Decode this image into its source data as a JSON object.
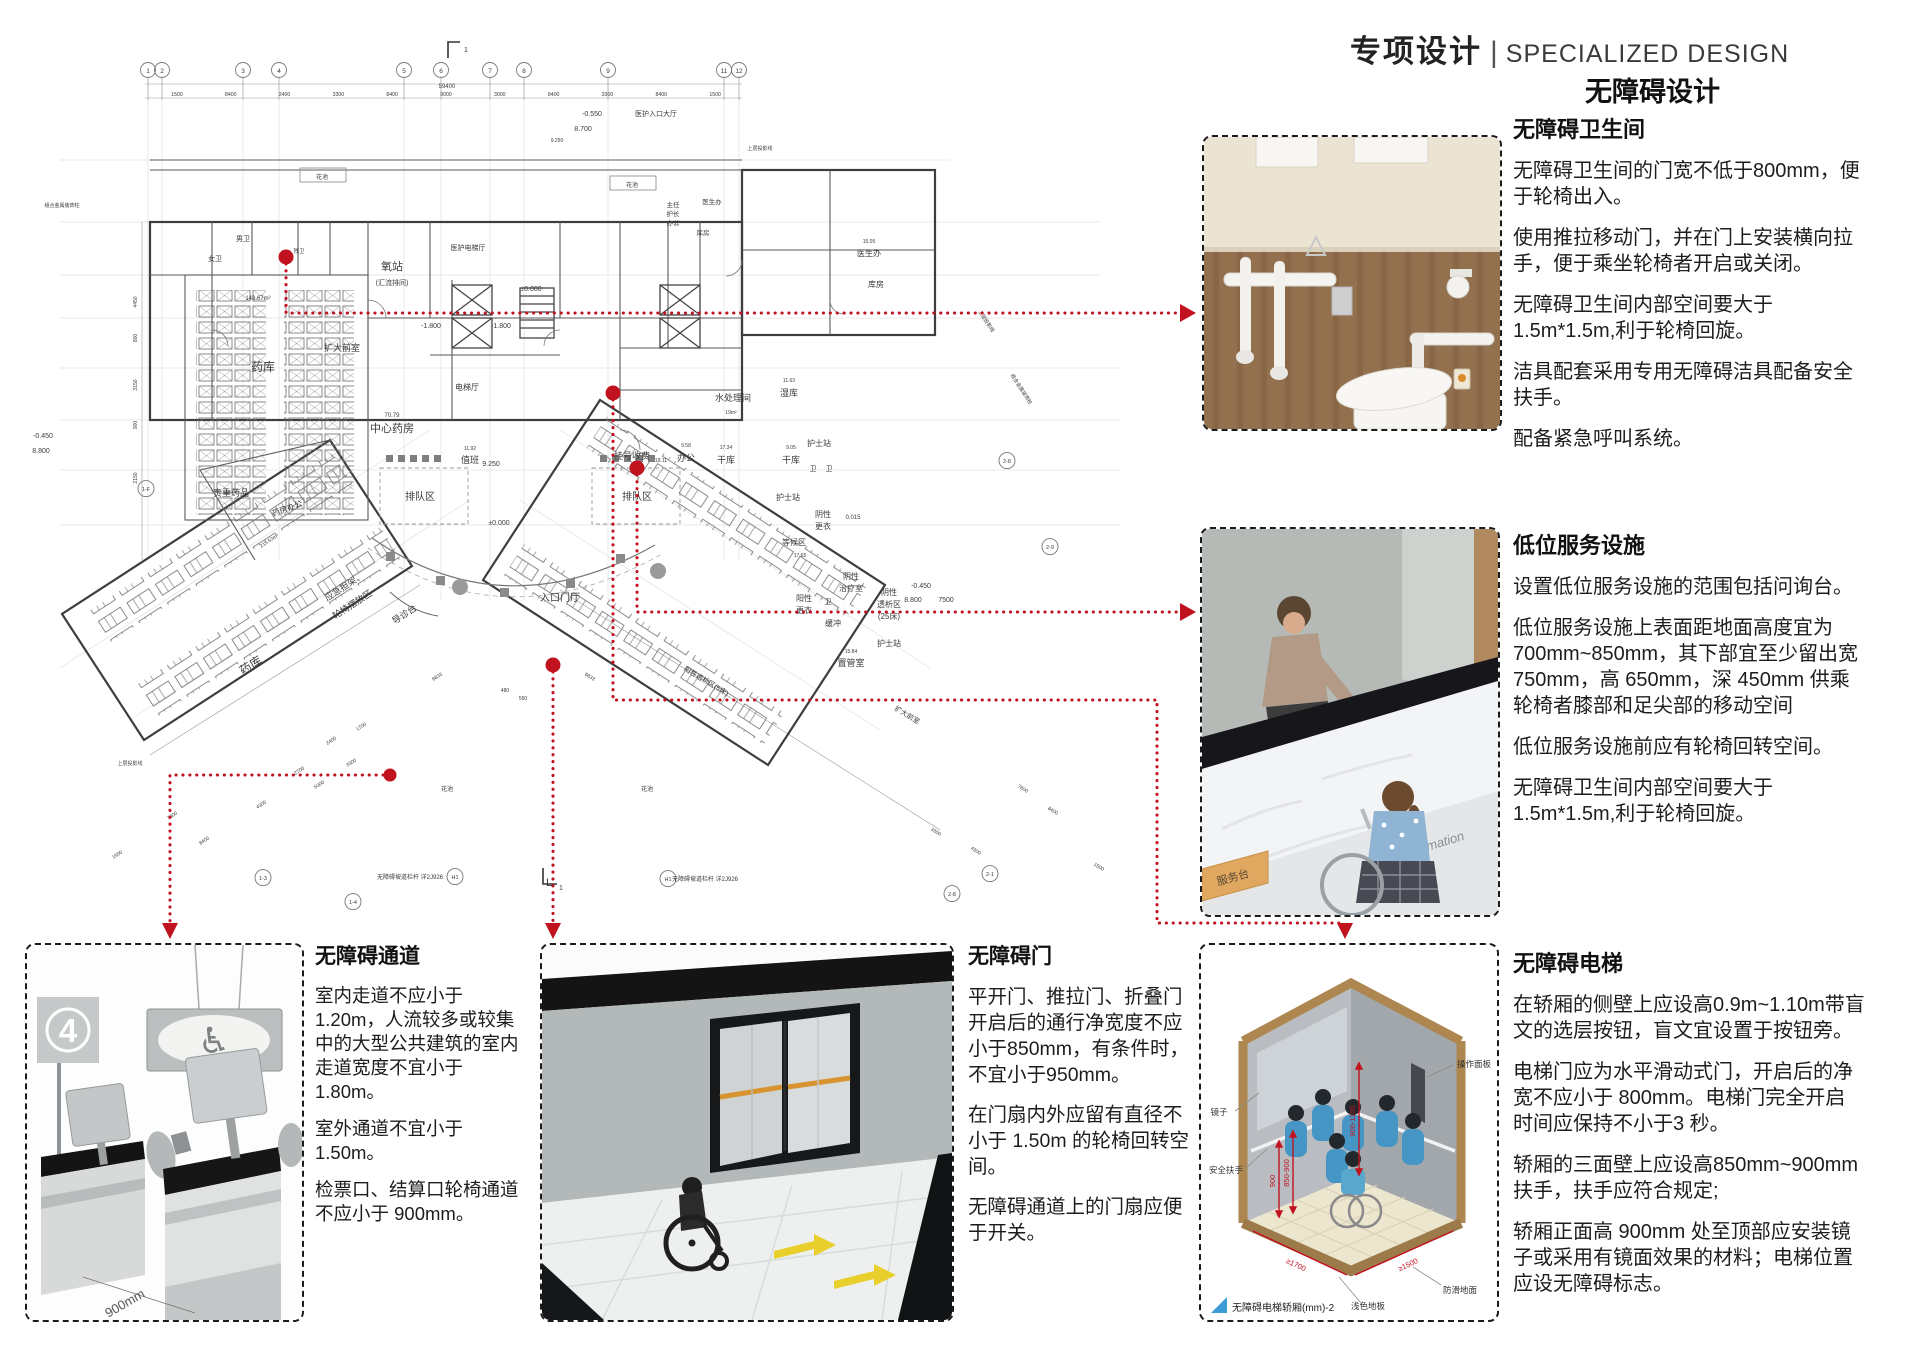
{
  "header": {
    "title_cn": "专项设计",
    "divider": "|",
    "title_en": "SPECIALIZED DESIGN",
    "subtitle": "无障碍设计"
  },
  "colors": {
    "annotation_red": "#c1121f",
    "caption_blue": "#3a9bd5",
    "accent_orange": "#d7932f",
    "wood": "#93704e"
  },
  "sections": {
    "toilet": {
      "title": "无障碍卫生间",
      "paragraphs": [
        "无障碍卫生间的门宽不低于800mm，便于轮椅出入。",
        "使用推拉移动门，并在门上安装横向拉手，便于乘坐轮椅者开启或关闭。",
        "无障碍卫生间内部空间要大于1.5m*1.5m,利于轮椅回旋。",
        "洁具配套采用专用无障碍洁具配备安全扶手。",
        "配备紧急呼叫系统。"
      ]
    },
    "service": {
      "title": "低位服务设施",
      "paragraphs": [
        "设置低位服务设施的范围包括问询台。",
        "低位服务设施上表面距地面高度宜为700mm~850mm，其下部宜至少留出宽 750mm，高 650mm，深 450mm 供乘轮椅者膝部和足尖部的移动空间",
        "低位服务设施前应有轮椅回转空间。",
        "无障碍卫生间内部空间要大于1.5m*1.5m,利于轮椅回旋。"
      ]
    },
    "lift": {
      "title": "无障碍电梯",
      "paragraphs": [
        "在轿厢的侧壁上应设高0.9m~1.10m带盲文的选层按钮，盲文宜设置于按钮旁。",
        "电梯门应为水平滑动式门，开启后的净宽不应小于 800mm。电梯门完全开启时间应保持不小于3 秒。",
        "轿厢的三面壁上应设高850mm~900mm 扶手，扶手应符合规定;",
        "轿厢正面高 900mm 处至顶部应安装镜子或采用有镜面效果的材料；电梯位置应设无障碍标志。"
      ]
    },
    "passage": {
      "title": "无障碍通道",
      "paragraphs": [
        "室内走道不应小于1.20m，人流较多或较集中的大型公共建筑的室内走道宽度不宜小于1.80m。",
        "室外通道不宜小于1.50m。",
        "检票口、结算口轮椅通道不应小于 900mm。"
      ]
    },
    "door": {
      "title": "无障碍门",
      "paragraphs": [
        "平开门、推拉门、折叠门开启后的通行净宽度不应小于850mm，有条件时，不宜小于950mm。",
        "在门扇内外应留有直径不小于 1.50m 的轮椅回转空间。",
        "无障碍通道上的门扇应便于开关。"
      ]
    }
  },
  "figures": {
    "passage": {
      "sign_number": "4",
      "wheelchair_symbol": "♿",
      "dim_label": "900mm"
    },
    "counter": {
      "counter_text": "Information",
      "sign_text": "服务台"
    },
    "lift": {
      "caption": "无障碍电梯轿厢(mm)-2",
      "labels": {
        "panel": "操作面板",
        "mirror": "镜子",
        "handrail": "安全扶手",
        "antislip": "防滑地面",
        "floor": "浅色地板"
      },
      "dims": {
        "side": "900-1100",
        "rail": "850-900",
        "low": "900",
        "depth": "≥1700",
        "width": "≥1500"
      }
    }
  },
  "floor_plan": {
    "total_dim": "59400",
    "top_dims": [
      "1500",
      "8400",
      "2400",
      "3300",
      "8400",
      "9000",
      "3000",
      "8400",
      "3300",
      "8400",
      "1500"
    ],
    "grid_bubbles": [
      [
        "1",
        148
      ],
      [
        "2",
        162
      ],
      [
        "3",
        243
      ],
      [
        "4",
        279
      ],
      [
        "5",
        404
      ],
      [
        "6",
        441
      ],
      [
        "7",
        490
      ],
      [
        "8",
        524
      ],
      [
        "9",
        608
      ],
      [
        "11",
        724
      ],
      [
        "12",
        739
      ]
    ],
    "side_bubbles": [
      [
        "1-F",
        146,
        491
      ],
      [
        "1-3",
        263,
        880
      ],
      [
        "1-4",
        353,
        904
      ],
      [
        "2-8",
        952,
        896
      ],
      [
        "2-1",
        990,
        876
      ],
      [
        "2-8",
        1007,
        463
      ],
      [
        "2-9",
        1050,
        549
      ],
      [
        "H1",
        455,
        879
      ],
      [
        "H1",
        668,
        881
      ]
    ],
    "labels": [
      [
        "男卫",
        243,
        241,
        7
      ],
      [
        "女卫",
        215,
        261,
        7
      ],
      [
        "残卫",
        299,
        253,
        5.5
      ],
      [
        "药库",
        263,
        371,
        12
      ],
      [
        "148.67m²",
        258,
        300,
        6
      ],
      [
        "氧站",
        392,
        270,
        11
      ],
      [
        "(汇流排间)",
        392,
        285,
        7
      ],
      [
        "医护电梯厅",
        468,
        250,
        7
      ],
      [
        "扩大前室",
        342,
        351,
        9
      ],
      [
        "中心药房",
        392,
        432,
        11
      ],
      [
        "70.79",
        392,
        417,
        6
      ],
      [
        "电梯厅",
        467,
        390,
        8
      ],
      [
        "-1.800",
        431,
        328,
        7
      ],
      [
        "-1.800",
        501,
        328,
        7
      ],
      [
        "±0.000",
        531,
        291,
        7
      ],
      [
        "9.250",
        491,
        466,
        7
      ],
      [
        "±0.000",
        499,
        525,
        7
      ],
      [
        "值班",
        470,
        463,
        9
      ],
      [
        "11.92",
        470,
        450,
        5
      ],
      [
        "排队区",
        420,
        500,
        10
      ],
      [
        "排队区",
        637,
        500,
        10
      ],
      [
        "挂号收费",
        632,
        459,
        9
      ],
      [
        "18.11",
        661,
        462,
        5
      ],
      [
        "办公",
        686,
        461,
        9
      ],
      [
        "9.58",
        686,
        447,
        5
      ],
      [
        "干库",
        726,
        463,
        9
      ],
      [
        "17.34",
        726,
        449,
        5
      ],
      [
        "水处理间",
        733,
        401,
        9
      ],
      [
        "19m²",
        731,
        414,
        5
      ],
      [
        "湿库",
        789,
        396,
        9
      ],
      [
        "11.63",
        789,
        382,
        5
      ],
      [
        "干库",
        791,
        463,
        9
      ],
      [
        "9.05",
        791,
        449,
        5
      ],
      [
        "护士站",
        819,
        446,
        8
      ],
      [
        "卫",
        813,
        471,
        7
      ],
      [
        "卫",
        829,
        471,
        7
      ],
      [
        "护士站",
        788,
        500,
        8
      ],
      [
        "等候区",
        794,
        545,
        8
      ],
      [
        "17.65",
        800,
        557,
        5
      ],
      [
        "阴性",
        823,
        517,
        8
      ],
      [
        "更衣",
        823,
        529,
        8
      ],
      [
        "阴性",
        851,
        579,
        8
      ],
      [
        "治疗室",
        851,
        591,
        8
      ],
      [
        "阳性",
        804,
        601,
        8
      ],
      [
        "更衣",
        804,
        613,
        8
      ],
      [
        "卫",
        828,
        604,
        7
      ],
      [
        "缓冲",
        833,
        626,
        8
      ],
      [
        "阴性",
        889,
        595,
        8
      ],
      [
        "透析区",
        889,
        607,
        8
      ],
      [
        "(25床)",
        889,
        619,
        8
      ],
      [
        "护士站",
        889,
        646,
        8
      ],
      [
        "置管室",
        851,
        666,
        9
      ],
      [
        "15.84",
        851,
        653,
        5
      ],
      [
        "贵重药品",
        231,
        496,
        9
      ],
      [
        "药房办公",
        288,
        511,
        8,
        -20
      ],
      [
        "应急担架、",
        346,
        589,
        9,
        -33
      ],
      [
        "轮椅摆放区",
        354,
        607,
        9,
        -33
      ],
      [
        "导诊台",
        406,
        617,
        9,
        -33
      ],
      [
        "药库",
        253,
        669,
        12,
        -33
      ],
      [
        "215.53m²",
        270,
        542,
        5,
        -33
      ],
      [
        "入口门厅",
        560,
        601,
        10
      ],
      [
        "主任",
        673,
        207,
        6.5
      ],
      [
        "护长",
        673,
        216,
        6.5
      ],
      [
        "办公",
        673,
        225,
        6.5
      ],
      [
        "医生办",
        712,
        204,
        6.5
      ],
      [
        "库房",
        703,
        235,
        6.5
      ],
      [
        "医生办",
        869,
        256,
        8
      ],
      [
        "15.05",
        869,
        243,
        5
      ],
      [
        "库房",
        876,
        287,
        8
      ],
      [
        "阳性透析区(5床)",
        705,
        683,
        7,
        31
      ],
      [
        "扩大前室",
        906,
        717,
        7,
        31
      ],
      [
        "-0.450",
        43,
        438,
        7
      ],
      [
        "8.800",
        41,
        453,
        7
      ],
      [
        "-0.550",
        592,
        116,
        7
      ],
      [
        "医护入口大厅",
        656,
        116,
        7
      ],
      [
        "8.700",
        583,
        131,
        7
      ],
      [
        "-0.450",
        921,
        588,
        7
      ],
      [
        "8.800",
        913,
        602,
        7
      ],
      [
        "7500",
        946,
        602,
        7
      ],
      [
        "0.015",
        853,
        519,
        6
      ],
      [
        "花池",
        322,
        179,
        6
      ],
      [
        "花池",
        632,
        187,
        6
      ],
      [
        "花池",
        447,
        791,
        6
      ],
      [
        "花池",
        647,
        791,
        6
      ],
      [
        "上层投影线",
        130,
        765,
        5
      ],
      [
        "上层投影线",
        985,
        322,
        5,
        57
      ],
      [
        "组合金属装饰柱",
        62,
        207,
        5
      ],
      [
        "组合金属装饰柱",
        1020,
        390,
        5,
        57
      ],
      [
        "59400",
        447,
        88,
        6
      ],
      [
        "6833",
        438,
        678,
        5,
        -33
      ],
      [
        "6833",
        589,
        678,
        5,
        33
      ],
      [
        "550",
        523,
        700,
        5
      ],
      [
        "480",
        505,
        692,
        5
      ],
      [
        "无障碍坡道栏杆 详2J926",
        410,
        879,
        6
      ],
      [
        "无障碍坡道栏杆 详2J926",
        705,
        881,
        6
      ],
      [
        "L",
        549,
        886,
        11
      ],
      [
        "1",
        561,
        890,
        7
      ],
      [
        "1",
        466,
        52,
        7
      ],
      [
        "4450",
        137,
        302,
        5,
        -90
      ],
      [
        "800",
        137,
        338,
        5,
        -90
      ],
      [
        "3150",
        137,
        385,
        5,
        -90
      ],
      [
        "900",
        137,
        425,
        5,
        -90
      ],
      [
        "2150",
        137,
        478,
        5,
        -90
      ],
      [
        "7800",
        173,
        817,
        5,
        -33
      ],
      [
        "8400",
        205,
        842,
        5,
        -33
      ],
      [
        "4300",
        262,
        806,
        5,
        -33
      ],
      [
        "1500",
        118,
        856,
        5,
        -33
      ],
      [
        "5300",
        320,
        786,
        5,
        -33
      ],
      [
        "3300",
        352,
        764,
        5,
        -33
      ],
      [
        "2700",
        300,
        772,
        5,
        -33
      ],
      [
        "2400",
        332,
        742,
        5,
        -33
      ],
      [
        "1700",
        362,
        728,
        5,
        -33
      ],
      [
        "7800",
        1022,
        790,
        5,
        33
      ],
      [
        "8400",
        1052,
        812,
        5,
        33
      ],
      [
        "3300",
        935,
        833,
        5,
        33
      ],
      [
        "4300",
        975,
        852,
        5,
        33
      ],
      [
        "1500",
        1098,
        868,
        5,
        33
      ],
      [
        "9.250",
        557,
        142,
        5
      ],
      [
        "上层投影线",
        760,
        150,
        5
      ]
    ]
  }
}
